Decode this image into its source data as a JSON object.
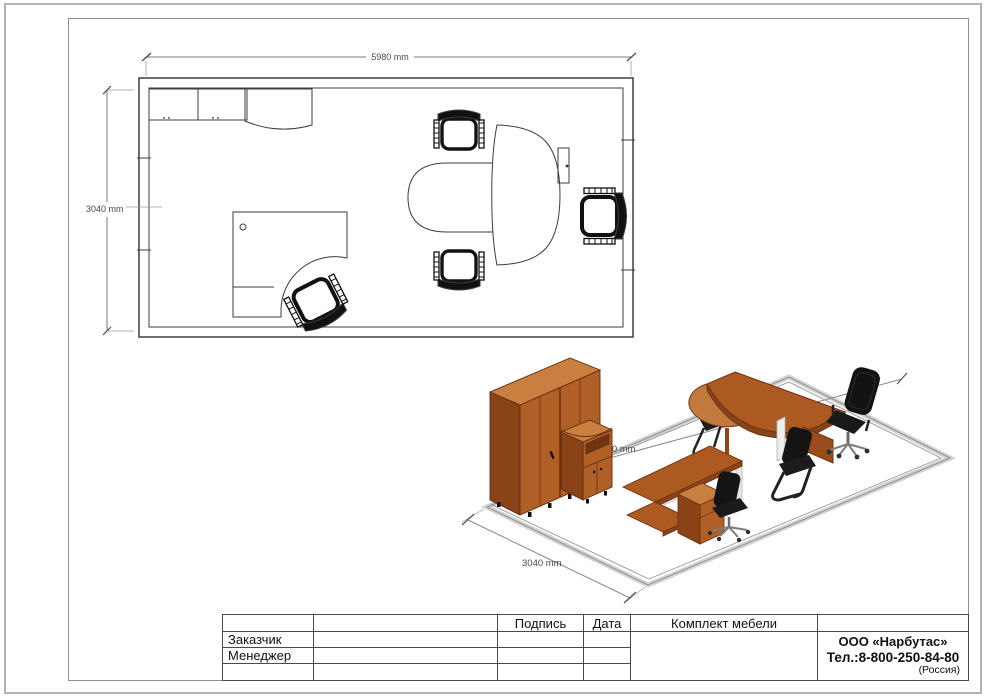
{
  "floor_plan": {
    "width_label": "5980 mm",
    "depth_label": "3040 mm"
  },
  "iso_view": {
    "depth_label": "3040 mm",
    "width_label": "5980 mm"
  },
  "title_block": {
    "col_signature": "Подпись",
    "col_date": "Дата",
    "project_title": "Комплект мебели",
    "row_customer": "Заказчик",
    "row_manager": "Менеджер",
    "company": {
      "name": "ООО «Нарбутас»",
      "phone": "Тел.:8-800-250-84-80",
      "country": "(Россия)"
    }
  }
}
